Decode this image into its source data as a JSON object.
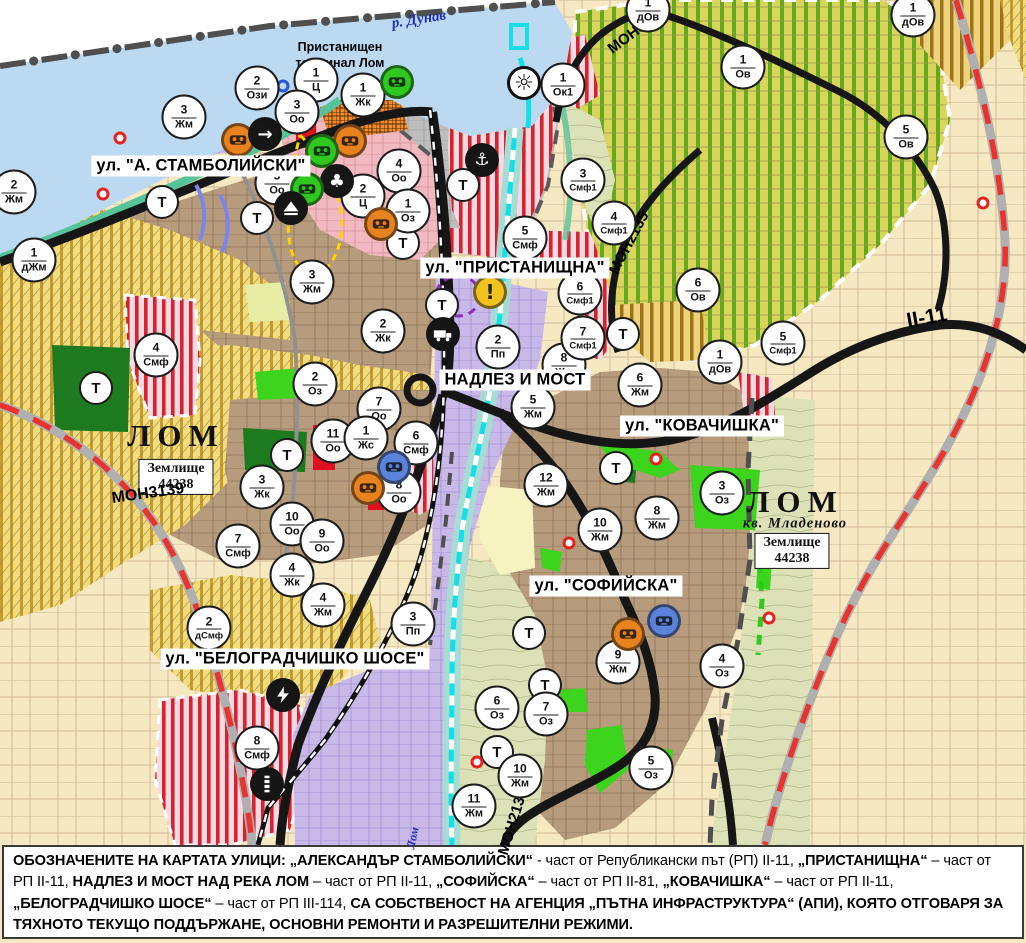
{
  "colors": {
    "poi-orange": "#e8821e",
    "poi-green": "#2ec81e",
    "poi-black": "#161616",
    "poi-blue": "#5b83dc",
    "poi-yellow": "#f2c21f",
    "water-danube": "#bcd9f2",
    "river-cyan": "#12dfe8",
    "ring-road-red": "#e8332e"
  },
  "map": {
    "danube_label": "р. Дунав",
    "lom_river_label": "Лом",
    "port_terminal_line1": "Пристанищен",
    "port_terminal_line2": "терминал Лом",
    "t_label": "Т",
    "city_labels": [
      {
        "text": "ЛОМ",
        "x": 176,
        "y": 436
      },
      {
        "text": "ЛОМ",
        "x": 795,
        "y": 502
      }
    ],
    "district_label": {
      "text": "кв. Младеново",
      "x": 795,
      "y": 524
    },
    "land_plots": [
      {
        "line1": "Землище",
        "line2": "44238",
        "x": 176,
        "y": 477
      },
      {
        "line1": "Землище",
        "line2": "44238",
        "x": 792,
        "y": 551
      }
    ],
    "street_labels": [
      {
        "text": "ул. \"А. СТАМБОЛИЙСКИ\"",
        "x": 201,
        "y": 166
      },
      {
        "text": "ул. \"ПРИСТАНИЩНА\"",
        "x": 515,
        "y": 268
      },
      {
        "text": "НАДЛЕЗ И МОСТ",
        "x": 515,
        "y": 380
      },
      {
        "text": "ул. \"КОВАЧИШКА\"",
        "x": 702,
        "y": 426
      },
      {
        "text": "ул. \"СОФИЙСКА\"",
        "x": 606,
        "y": 586
      },
      {
        "text": "ул. \"БЕЛОГРАДЧИШКО ШОСЕ\"",
        "x": 295,
        "y": 659
      }
    ],
    "road_labels": [
      {
        "text": "МОН3138",
        "x": 637,
        "y": 30,
        "rot": -37,
        "size": 15
      },
      {
        "text": "МОН2135",
        "x": 629,
        "y": 243,
        "rot": -62,
        "size": 15
      },
      {
        "text": "II-11",
        "x": 927,
        "y": 318,
        "rot": -10,
        "size": 21
      },
      {
        "text": "МОН3139",
        "x": 148,
        "y": 494,
        "rot": -8,
        "size": 16
      },
      {
        "text": "МОН2136",
        "x": 513,
        "y": 822,
        "rot": -73,
        "size": 15
      }
    ],
    "zone_markers": [
      {
        "n": "3",
        "c": "Жм",
        "x": 184,
        "y": 117
      },
      {
        "n": "2",
        "c": "Ози",
        "x": 257,
        "y": 88
      },
      {
        "n": "1",
        "c": "Ц",
        "x": 316,
        "y": 80
      },
      {
        "n": "3",
        "c": "Оо",
        "x": 297,
        "y": 112
      },
      {
        "n": "1",
        "c": "Жк",
        "x": 363,
        "y": 95
      },
      {
        "n": "2",
        "c": "Жм",
        "x": 14,
        "y": 192
      },
      {
        "n": "1",
        "c": "дЖм",
        "x": 34,
        "y": 260
      },
      {
        "n": "4",
        "c": "Оо",
        "x": 399,
        "y": 171
      },
      {
        "n": "2",
        "c": "Ц",
        "x": 363,
        "y": 196
      },
      {
        "n": "1",
        "c": "Оз",
        "x": 408,
        "y": 211
      },
      {
        "n": "3",
        "c": "Жм",
        "x": 312,
        "y": 282
      },
      {
        "n": "2",
        "c": "Жк",
        "x": 383,
        "y": 331
      },
      {
        "n": "2",
        "c": "Оз",
        "x": 315,
        "y": 384
      },
      {
        "n": "5",
        "c": "Оо",
        "x": 277,
        "y": 183
      },
      {
        "n": "7",
        "c": "Оо",
        "x": 379,
        "y": 409
      },
      {
        "n": "11",
        "c": "Оо",
        "x": 333,
        "y": 441
      },
      {
        "n": "1",
        "c": "Жс",
        "x": 366,
        "y": 438
      },
      {
        "n": "6",
        "c": "Смф",
        "x": 416,
        "y": 443
      },
      {
        "n": "8",
        "c": "Оо",
        "x": 399,
        "y": 492
      },
      {
        "n": "10",
        "c": "Оо",
        "x": 292,
        "y": 524
      },
      {
        "n": "9",
        "c": "Оо",
        "x": 322,
        "y": 541
      },
      {
        "n": "4",
        "c": "Жк",
        "x": 292,
        "y": 575
      },
      {
        "n": "3",
        "c": "Жк",
        "x": 262,
        "y": 487
      },
      {
        "n": "4",
        "c": "Смф",
        "x": 156,
        "y": 355
      },
      {
        "n": "7",
        "c": "Смф",
        "x": 238,
        "y": 546
      },
      {
        "n": "4",
        "c": "Жм",
        "x": 323,
        "y": 605
      },
      {
        "n": "2",
        "c": "дСмф",
        "x": 209,
        "y": 628
      },
      {
        "n": "3",
        "c": "Пп",
        "x": 413,
        "y": 624
      },
      {
        "n": "8",
        "c": "Смф",
        "x": 257,
        "y": 748
      },
      {
        "n": "11",
        "c": "Жм",
        "x": 474,
        "y": 806
      },
      {
        "n": "10",
        "c": "Жм",
        "x": 520,
        "y": 776
      },
      {
        "n": "6",
        "c": "Оз",
        "x": 497,
        "y": 708
      },
      {
        "n": "7",
        "c": "Оз",
        "x": 546,
        "y": 714
      },
      {
        "n": "5",
        "c": "Оз",
        "x": 651,
        "y": 768
      },
      {
        "n": "9",
        "c": "Жм",
        "x": 618,
        "y": 662
      },
      {
        "n": "4",
        "c": "Оз",
        "x": 722,
        "y": 666
      },
      {
        "n": "3",
        "c": "Оз",
        "x": 722,
        "y": 493
      },
      {
        "n": "8",
        "c": "Жм",
        "x": 657,
        "y": 518
      },
      {
        "n": "10",
        "c": "Жм",
        "x": 600,
        "y": 530
      },
      {
        "n": "12",
        "c": "Жм",
        "x": 546,
        "y": 485
      },
      {
        "n": "6",
        "c": "Жм",
        "x": 640,
        "y": 385
      },
      {
        "n": "5",
        "c": "Жм",
        "x": 533,
        "y": 407
      },
      {
        "n": "8",
        "c": "Жм",
        "x": 564,
        "y": 365
      },
      {
        "n": "2",
        "c": "Пп",
        "x": 498,
        "y": 347
      },
      {
        "n": "7",
        "c": "Смф1",
        "x": 583,
        "y": 338
      },
      {
        "n": "6",
        "c": "Смф1",
        "x": 580,
        "y": 293
      },
      {
        "n": "4",
        "c": "Смф1",
        "x": 614,
        "y": 223
      },
      {
        "n": "5",
        "c": "Смф",
        "x": 525,
        "y": 238
      },
      {
        "n": "3",
        "c": "Смф1",
        "x": 583,
        "y": 180
      },
      {
        "n": "1",
        "c": "Ок1",
        "x": 563,
        "y": 85
      },
      {
        "n": "1",
        "c": "Ов",
        "x": 743,
        "y": 67
      },
      {
        "n": "5",
        "c": "Ов",
        "x": 906,
        "y": 137
      },
      {
        "n": "1",
        "c": "дОв",
        "x": 913,
        "y": 15
      },
      {
        "n": "1",
        "c": "дОв",
        "x": 648,
        "y": 10
      },
      {
        "n": "6",
        "c": "Ов",
        "x": 698,
        "y": 290
      },
      {
        "n": "1",
        "c": "дОв",
        "x": 720,
        "y": 362
      },
      {
        "n": "5",
        "c": "Смф1",
        "x": 783,
        "y": 343
      }
    ],
    "t_markers": [
      [
        162,
        202
      ],
      [
        257,
        218
      ],
      [
        403,
        243
      ],
      [
        463,
        185
      ],
      [
        442,
        305
      ],
      [
        96,
        388
      ],
      [
        287,
        455
      ],
      [
        616,
        468
      ],
      [
        623,
        334
      ],
      [
        529,
        633
      ],
      [
        545,
        685
      ],
      [
        497,
        752
      ]
    ],
    "poi_icons": [
      {
        "name": "monument-icon",
        "type": "mask",
        "color": "poi-orange",
        "x": 238,
        "y": 140
      },
      {
        "name": "arrow-icon",
        "type": "arrow",
        "color": "poi-black",
        "x": 265,
        "y": 134
      },
      {
        "name": "monument-icon",
        "type": "mask",
        "color": "poi-orange",
        "x": 350,
        "y": 141
      },
      {
        "name": "monument-icon",
        "type": "mask",
        "color": "poi-green",
        "x": 397,
        "y": 82
      },
      {
        "name": "monument-icon",
        "type": "mask",
        "color": "poi-green",
        "x": 322,
        "y": 151
      },
      {
        "name": "club-icon",
        "type": "club",
        "color": "poi-black",
        "x": 337,
        "y": 181
      },
      {
        "name": "monument-icon",
        "type": "mask",
        "color": "poi-green",
        "x": 307,
        "y": 189
      },
      {
        "name": "pyramid-icon",
        "type": "pyramid",
        "color": "poi-black",
        "x": 291,
        "y": 208
      },
      {
        "name": "monument-icon",
        "type": "mask",
        "color": "poi-orange",
        "x": 381,
        "y": 224
      },
      {
        "name": "monument-icon",
        "type": "mask",
        "color": "poi-blue",
        "x": 394,
        "y": 467
      },
      {
        "name": "monument-icon",
        "type": "mask",
        "color": "poi-orange",
        "x": 368,
        "y": 488
      },
      {
        "name": "monument-icon",
        "type": "mask",
        "color": "poi-blue",
        "x": 664,
        "y": 621
      },
      {
        "name": "monument-icon",
        "type": "mask",
        "color": "poi-orange",
        "x": 628,
        "y": 634
      },
      {
        "name": "anchor-icon",
        "type": "anchor",
        "color": "poi-black",
        "x": 482,
        "y": 160
      },
      {
        "name": "sun-icon",
        "type": "sun",
        "color": "#ffffff",
        "x": 524,
        "y": 83
      },
      {
        "name": "warning-icon",
        "type": "warn",
        "color": "poi-yellow",
        "x": 490,
        "y": 292
      },
      {
        "name": "truck-icon",
        "type": "truck",
        "color": "poi-black",
        "x": 443,
        "y": 334
      },
      {
        "name": "lightning-icon",
        "type": "bolt",
        "color": "poi-black",
        "x": 283,
        "y": 695
      },
      {
        "name": "railway-icon",
        "type": "rail",
        "color": "poi-black",
        "x": 267,
        "y": 784
      }
    ],
    "red_dots": [
      [
        120,
        138
      ],
      [
        103,
        194
      ],
      [
        656,
        459
      ],
      [
        569,
        543
      ],
      [
        769,
        618
      ],
      [
        477,
        762
      ],
      [
        983,
        203
      ]
    ],
    "blue_rings": [
      [
        283,
        86
      ]
    ]
  },
  "caption": {
    "segments": [
      {
        "t": "ОБОЗНАЧЕНИТЕ НА КАРТАТА УЛИЦИ: „АЛЕКСАНДЪР СТАМБОЛИЙСКИ“",
        "b": true
      },
      {
        "t": " - част от Републикански път (РП) II-11, ",
        "b": false
      },
      {
        "t": "„ПРИСТАНИЩНА“",
        "b": true
      },
      {
        "t": " – част от РП II-11, ",
        "b": false
      },
      {
        "t": "НАДЛЕЗ И МОСТ НАД РЕКА ЛОМ",
        "b": true
      },
      {
        "t": " – част от РП II-11, ",
        "b": false
      },
      {
        "t": "„СОФИЙСКА“",
        "b": true
      },
      {
        "t": " – част от РП II-81, ",
        "b": false
      },
      {
        "t": "„КОВАЧИШКА“",
        "b": true
      },
      {
        "t": " – част от РП II-11, ",
        "b": false
      },
      {
        "t": "„БЕЛОГРАДЧИШКО ШОСЕ“",
        "b": true
      },
      {
        "t": " – част от РП III-114, ",
        "b": false
      },
      {
        "t": "СА СОБСТВЕНОСТ НА АГЕНЦИЯ „ПЪТНА ИНФРАСТРУКТУРА“ (АПИ), КОЯТО ОТГОВАРЯ ЗА ТЯХНОТО ТЕКУЩО ПОДДЪРЖАНЕ, ОСНОВНИ РЕМОНТИ И РАЗРЕШИТЕЛНИ РЕЖИМИ.",
        "b": true
      }
    ]
  }
}
